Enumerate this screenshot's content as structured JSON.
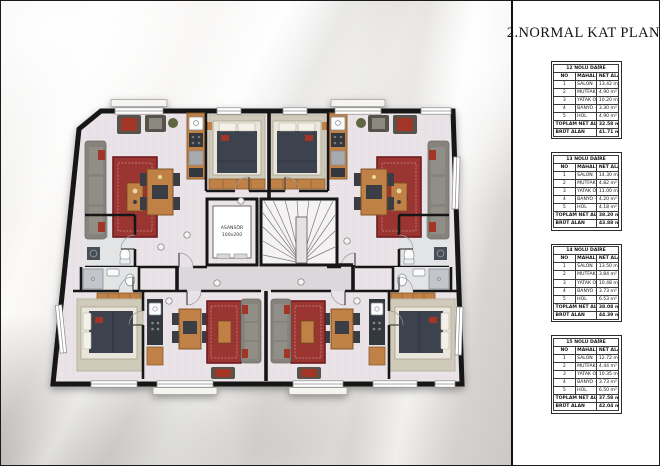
{
  "title": "2.NORMAL KAT PLANI",
  "plan": {
    "elevator_label": "ASANSÖR",
    "elevator_size": "100x200"
  },
  "colors": {
    "wall": "#161616",
    "floor": "#eae4e8",
    "corridor": "#dcd7da",
    "wood": "#c08146",
    "rug_red": "#9b3433",
    "sofa_gray": "#85837b",
    "bed_dark": "#3c4250",
    "accent_red": "#a33527"
  },
  "tables": [
    {
      "name": "12 NOLU DAİRE",
      "columns": [
        "NO",
        "MAHAL",
        "NET ALAN"
      ],
      "rows": [
        [
          "1",
          "SALON",
          "13.42 m²"
        ],
        [
          "2",
          "MUTFAK NİŞİ",
          "4.90 m²"
        ],
        [
          "3",
          "YATAK ODASI",
          "10.20 m²"
        ],
        [
          "4",
          "BANYO + WC",
          "3.30 m²"
        ],
        [
          "5",
          "HOL",
          "4.90 m²"
        ]
      ],
      "total_label": "TOPLAM NET ALAN",
      "total": "32.58 m²",
      "gross_label": "BRÜT ALAN",
      "gross": "41.71 m²"
    },
    {
      "name": "13 NOLU DAİRE",
      "columns": [
        "NO",
        "MAHAL",
        "NET ALAN"
      ],
      "rows": [
        [
          "1",
          "SALON",
          "14.30 m²"
        ],
        [
          "2",
          "MUTFAK NİŞİ",
          "4.82 m²"
        ],
        [
          "3",
          "YATAK ODASI",
          "11.00 m²"
        ],
        [
          "4",
          "BANYO + WC",
          "4.20 m²"
        ],
        [
          "5",
          "HOL",
          "4.18 m²"
        ]
      ],
      "total_label": "TOPLAM NET ALAN",
      "total": "38.20 m²",
      "gross_label": "BRÜT ALAN",
      "gross": "43.88 m²"
    },
    {
      "name": "14 NOLU DAİRE",
      "columns": [
        "NO",
        "MAHAL",
        "NET ALAN"
      ],
      "rows": [
        [
          "1",
          "SALON",
          "13.50 m²"
        ],
        [
          "2",
          "MUTFAK NİŞİ",
          "3.84 m²"
        ],
        [
          "3",
          "YATAK ODASI",
          "10.48 m²"
        ],
        [
          "4",
          "BANYO + WC",
          "3.73 m²"
        ],
        [
          "5",
          "HOL",
          "6.53 m²"
        ]
      ],
      "total_label": "TOPLAM NET ALAN",
      "total": "38.08 m²",
      "gross_label": "BRÜT ALAN",
      "gross": "44.39 m²"
    },
    {
      "name": "15 NOLU DAİRE",
      "columns": [
        "NO",
        "MAHAL",
        "NET ALAN"
      ],
      "rows": [
        [
          "1",
          "SALON",
          "12.72 m²"
        ],
        [
          "2",
          "MUTFAK NİŞİ",
          "4.44 m²"
        ],
        [
          "3",
          "YATAK ODASI",
          "10.35 m²"
        ],
        [
          "4",
          "BANYO + WC",
          "3.73 m²"
        ],
        [
          "5",
          "HOL",
          "6.50 m²"
        ]
      ],
      "total_label": "TOPLAM NET ALAN",
      "total": "37.58 m²",
      "gross_label": "BRÜT ALAN",
      "gross": "42.04 m²"
    }
  ]
}
